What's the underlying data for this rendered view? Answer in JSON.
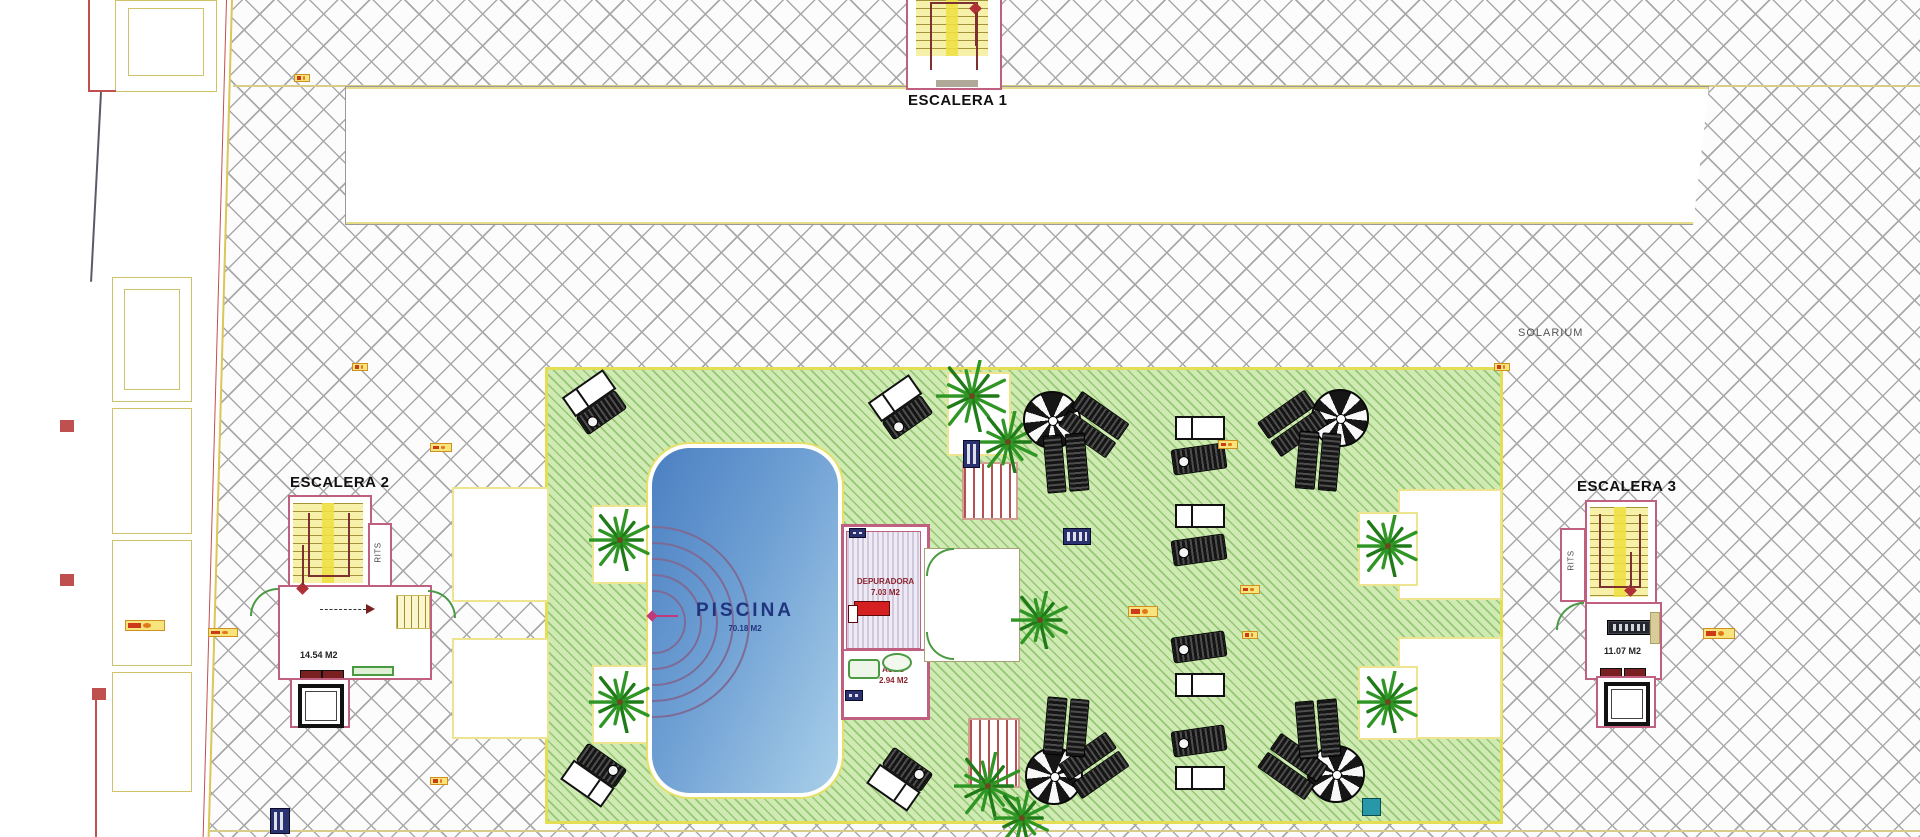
{
  "labels": {
    "escalera1": "ESCALERA 1",
    "escalera2": "ESCALERA 2",
    "escalera3": "ESCALERA 3",
    "solarium": "SOLARIUM",
    "rits": "RITS"
  },
  "pool": {
    "name": "PISCINA",
    "area": "70.18 M2"
  },
  "rooms": {
    "depuradora": {
      "name": "DEPURADORA",
      "area": "7.03 M2"
    },
    "aseo": {
      "name": "ASEO",
      "area": "2.94 M2"
    },
    "escalera2_area": "14.54 M2",
    "escalera3_area": "11.07 M2"
  },
  "colors": {
    "hatch_line": "#a9a9a9",
    "boundary_yellow": "#d9c757",
    "boundary_red": "#c05050",
    "green_fill": "#cfeab2",
    "green_border": "#e4de55",
    "pool_dark": "#4b80c2",
    "pool_light": "#a9cfe9",
    "pool_text": "#20357e",
    "wall_pink": "#c06080",
    "stair_yellow": "#f6f0a8",
    "stair_column": "#f0df45",
    "rail_red": "#7c3030",
    "red_marker": "#b03038",
    "room_text_red": "#8c2430",
    "palm_green": "#2f9625",
    "umbrella_dark": "#161616",
    "badge_orange_bg": "#f8e47c",
    "badge_orange_border": "#d09020",
    "badge_blue": "#2a3270",
    "teal": "#2898a8"
  }
}
